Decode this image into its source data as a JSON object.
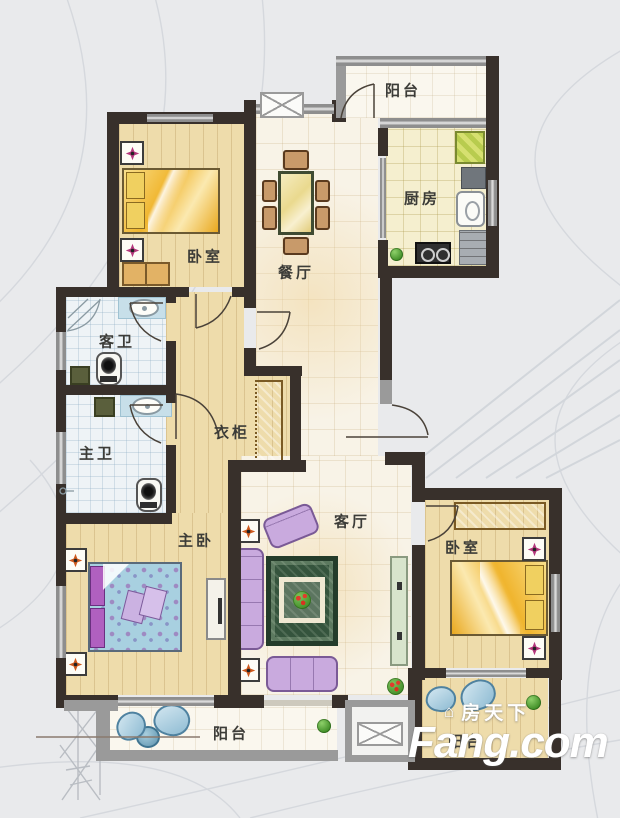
{
  "watermark": {
    "brand_cn": "房天下",
    "brand_en": "Fang.com"
  },
  "icons": {
    "house": "⌂"
  },
  "rooms": [
    {
      "id": "balcony-top",
      "label": "阳台"
    },
    {
      "id": "bedroom-upper-left",
      "label": "卧室"
    },
    {
      "id": "dining-room",
      "label": "餐厅"
    },
    {
      "id": "kitchen",
      "label": "厨房"
    },
    {
      "id": "guest-bathroom",
      "label": "客卫"
    },
    {
      "id": "master-bathroom",
      "label": "主卫"
    },
    {
      "id": "wardrobe-closet",
      "label": "衣柜"
    },
    {
      "id": "master-bedroom",
      "label": "主卧"
    },
    {
      "id": "living-room",
      "label": "客厅"
    },
    {
      "id": "bedroom-right",
      "label": "卧室"
    },
    {
      "id": "balcony-bottom-left",
      "label": "阳台"
    },
    {
      "id": "balcony-bottom-right",
      "label": "阳台"
    }
  ],
  "palette": {
    "background": "#e9eaec",
    "wall_dark": "#38302b",
    "wall_window_gray": "#8e8e8e",
    "wood_floor": "#eedcab",
    "tile_cream": "#f8f3e7",
    "bath_tile": "#eef3f6",
    "kitchen_floor": "#f5efcf",
    "sofa_lavender": "#c9aade",
    "rug_green": "#35543d",
    "bed_yellow": "#f2c04a",
    "bed_blue_floral": "#a8d0e0",
    "lamp_star_pink": "#b5377d",
    "lamp_star_orange": "#cf5a1e",
    "plant_green": "#4f9e35"
  }
}
